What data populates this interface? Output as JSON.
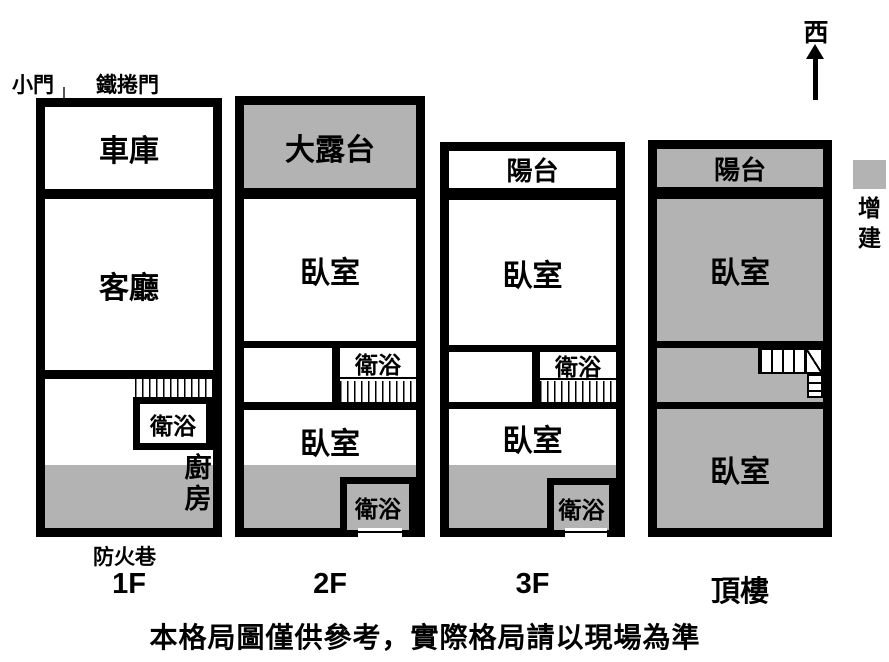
{
  "colors": {
    "addition_gray": "#b3b3b3",
    "wall": "#000000"
  },
  "compass": {
    "direction_label": "西"
  },
  "legend": {
    "swatch_color": "#b3b3b3",
    "line1": "增",
    "line2": "建"
  },
  "footer": {
    "disclaimer": "本格局圖僅供參考，實際格局請以現場為準"
  },
  "floor1": {
    "label": "1F",
    "small_door": "小門",
    "roller_door": "鐵捲門",
    "fire_lane": "防火巷",
    "garage": "車庫",
    "living_room": "客廳",
    "bathroom": "衛浴",
    "kitchen_char1": "廚",
    "kitchen_char2": "房"
  },
  "floor2": {
    "label": "2F",
    "terrace": "大露台",
    "bedroom_front": "臥室",
    "bathroom_mid": "衛浴",
    "bedroom_rear": "臥室",
    "bathroom_rear": "衛浴"
  },
  "floor3": {
    "label": "3F",
    "balcony": "陽台",
    "bedroom_front": "臥室",
    "bathroom_mid": "衛浴",
    "bedroom_rear": "臥室",
    "bathroom_rear": "衛浴"
  },
  "roof": {
    "label": "頂樓",
    "balcony": "陽台",
    "bedroom_front": "臥室",
    "bedroom_rear": "臥室"
  }
}
